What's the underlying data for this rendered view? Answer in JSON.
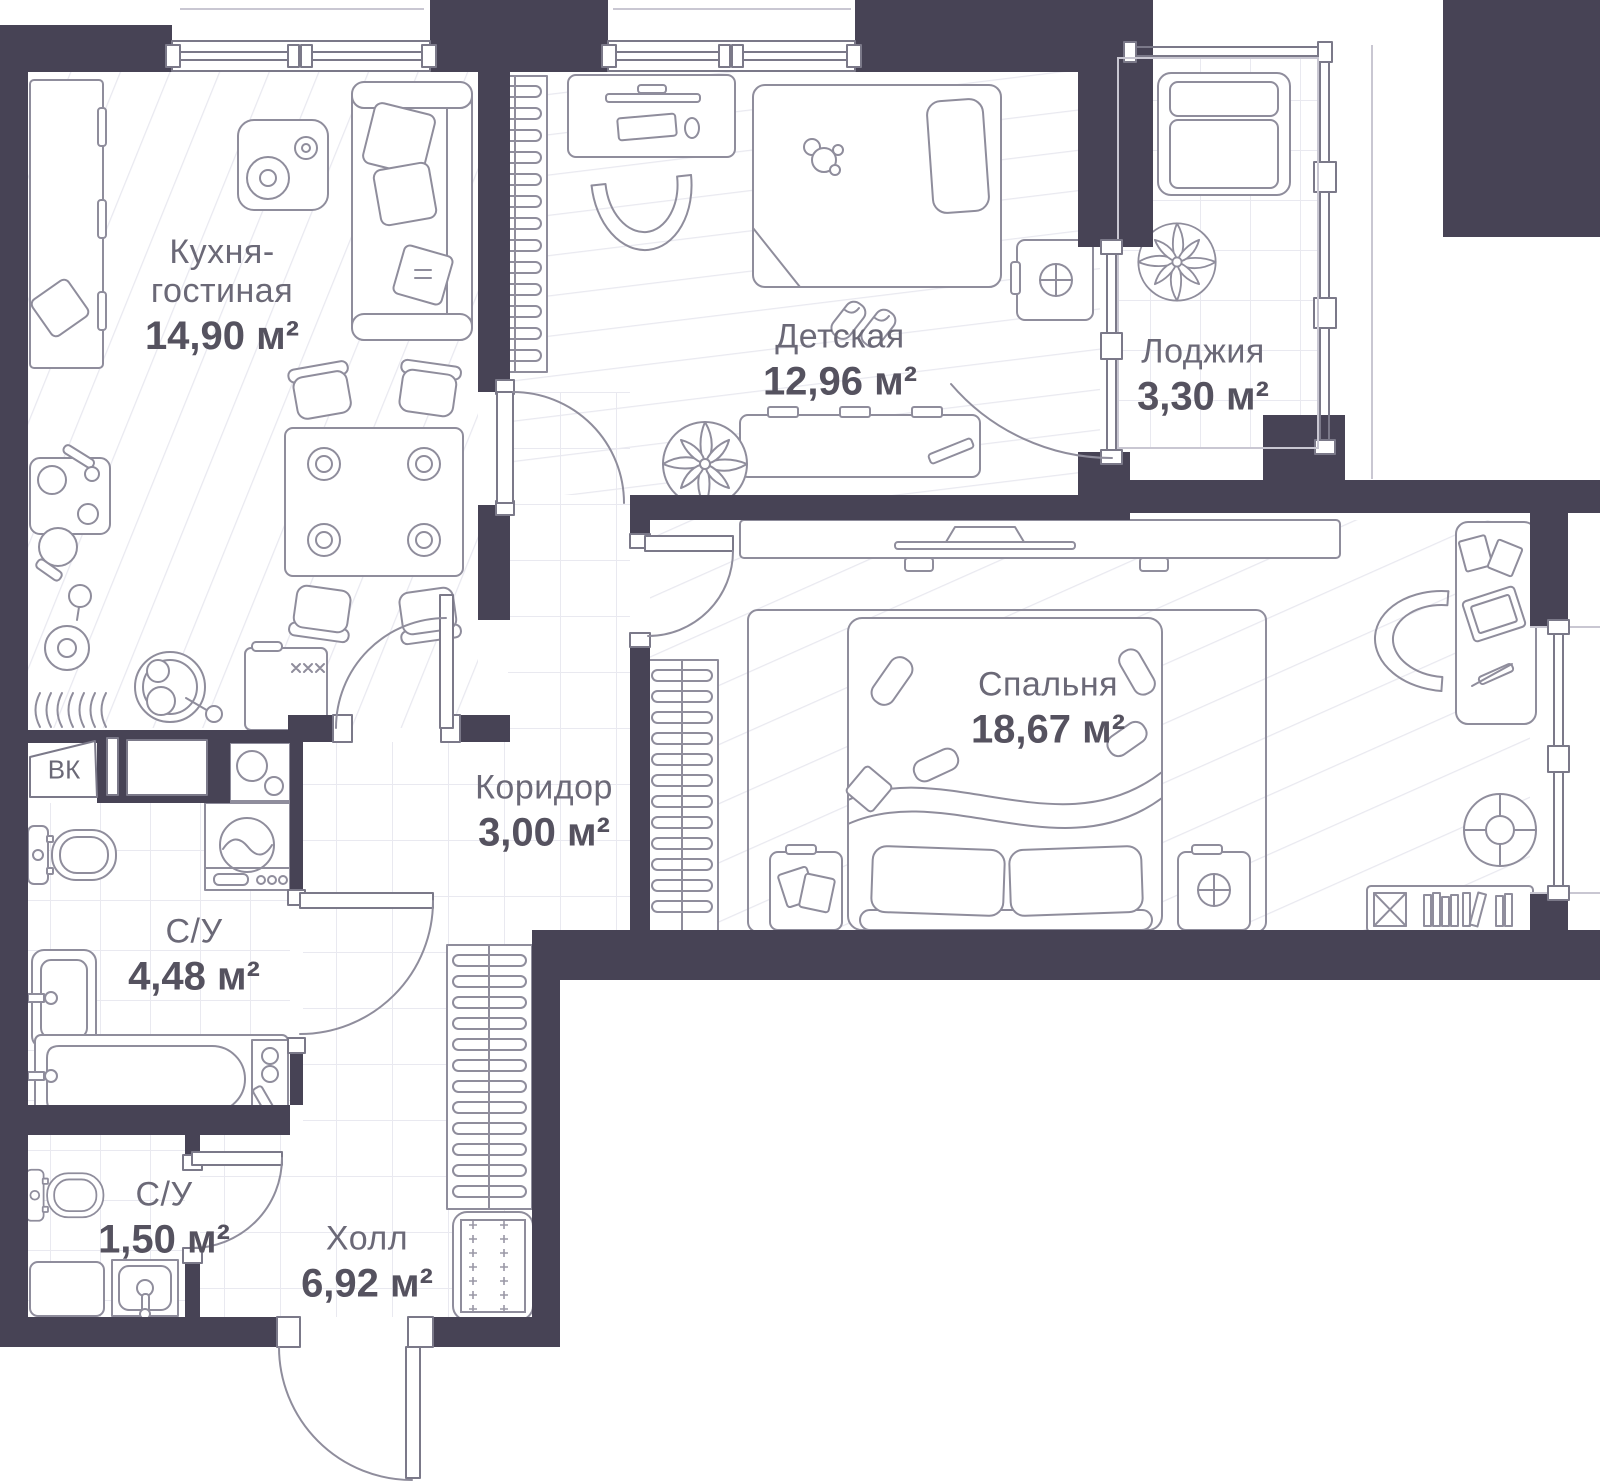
{
  "colors": {
    "wall": "#474355",
    "line": "#8f8d9c",
    "frame": "#7b7989",
    "hatch": "#e9e9f0",
    "text_primary": "#55525f",
    "text_secondary": "#6b6977",
    "marks": "#9a98a6",
    "background": "#ffffff"
  },
  "rooms": [
    {
      "id": "kitchen-living",
      "name": "Кухня-\nгостиная",
      "area": "14,90 м²"
    },
    {
      "id": "children-room",
      "name": "Детская",
      "area": "12,96 м²"
    },
    {
      "id": "loggia",
      "name": "Лоджия",
      "area": "3,30 м²"
    },
    {
      "id": "bedroom",
      "name": "Спальня",
      "area": "18,67 м²"
    },
    {
      "id": "corridor",
      "name": "Коридор",
      "area": "3,00 м²"
    },
    {
      "id": "bathroom-main",
      "name": "С/У",
      "area": "4,48 м²"
    },
    {
      "id": "bathroom-small",
      "name": "С/У",
      "area": "1,50 м²"
    },
    {
      "id": "hall",
      "name": "Холл",
      "area": "6,92 м²"
    }
  ],
  "annotations": {
    "shaft_label": "ВК"
  }
}
